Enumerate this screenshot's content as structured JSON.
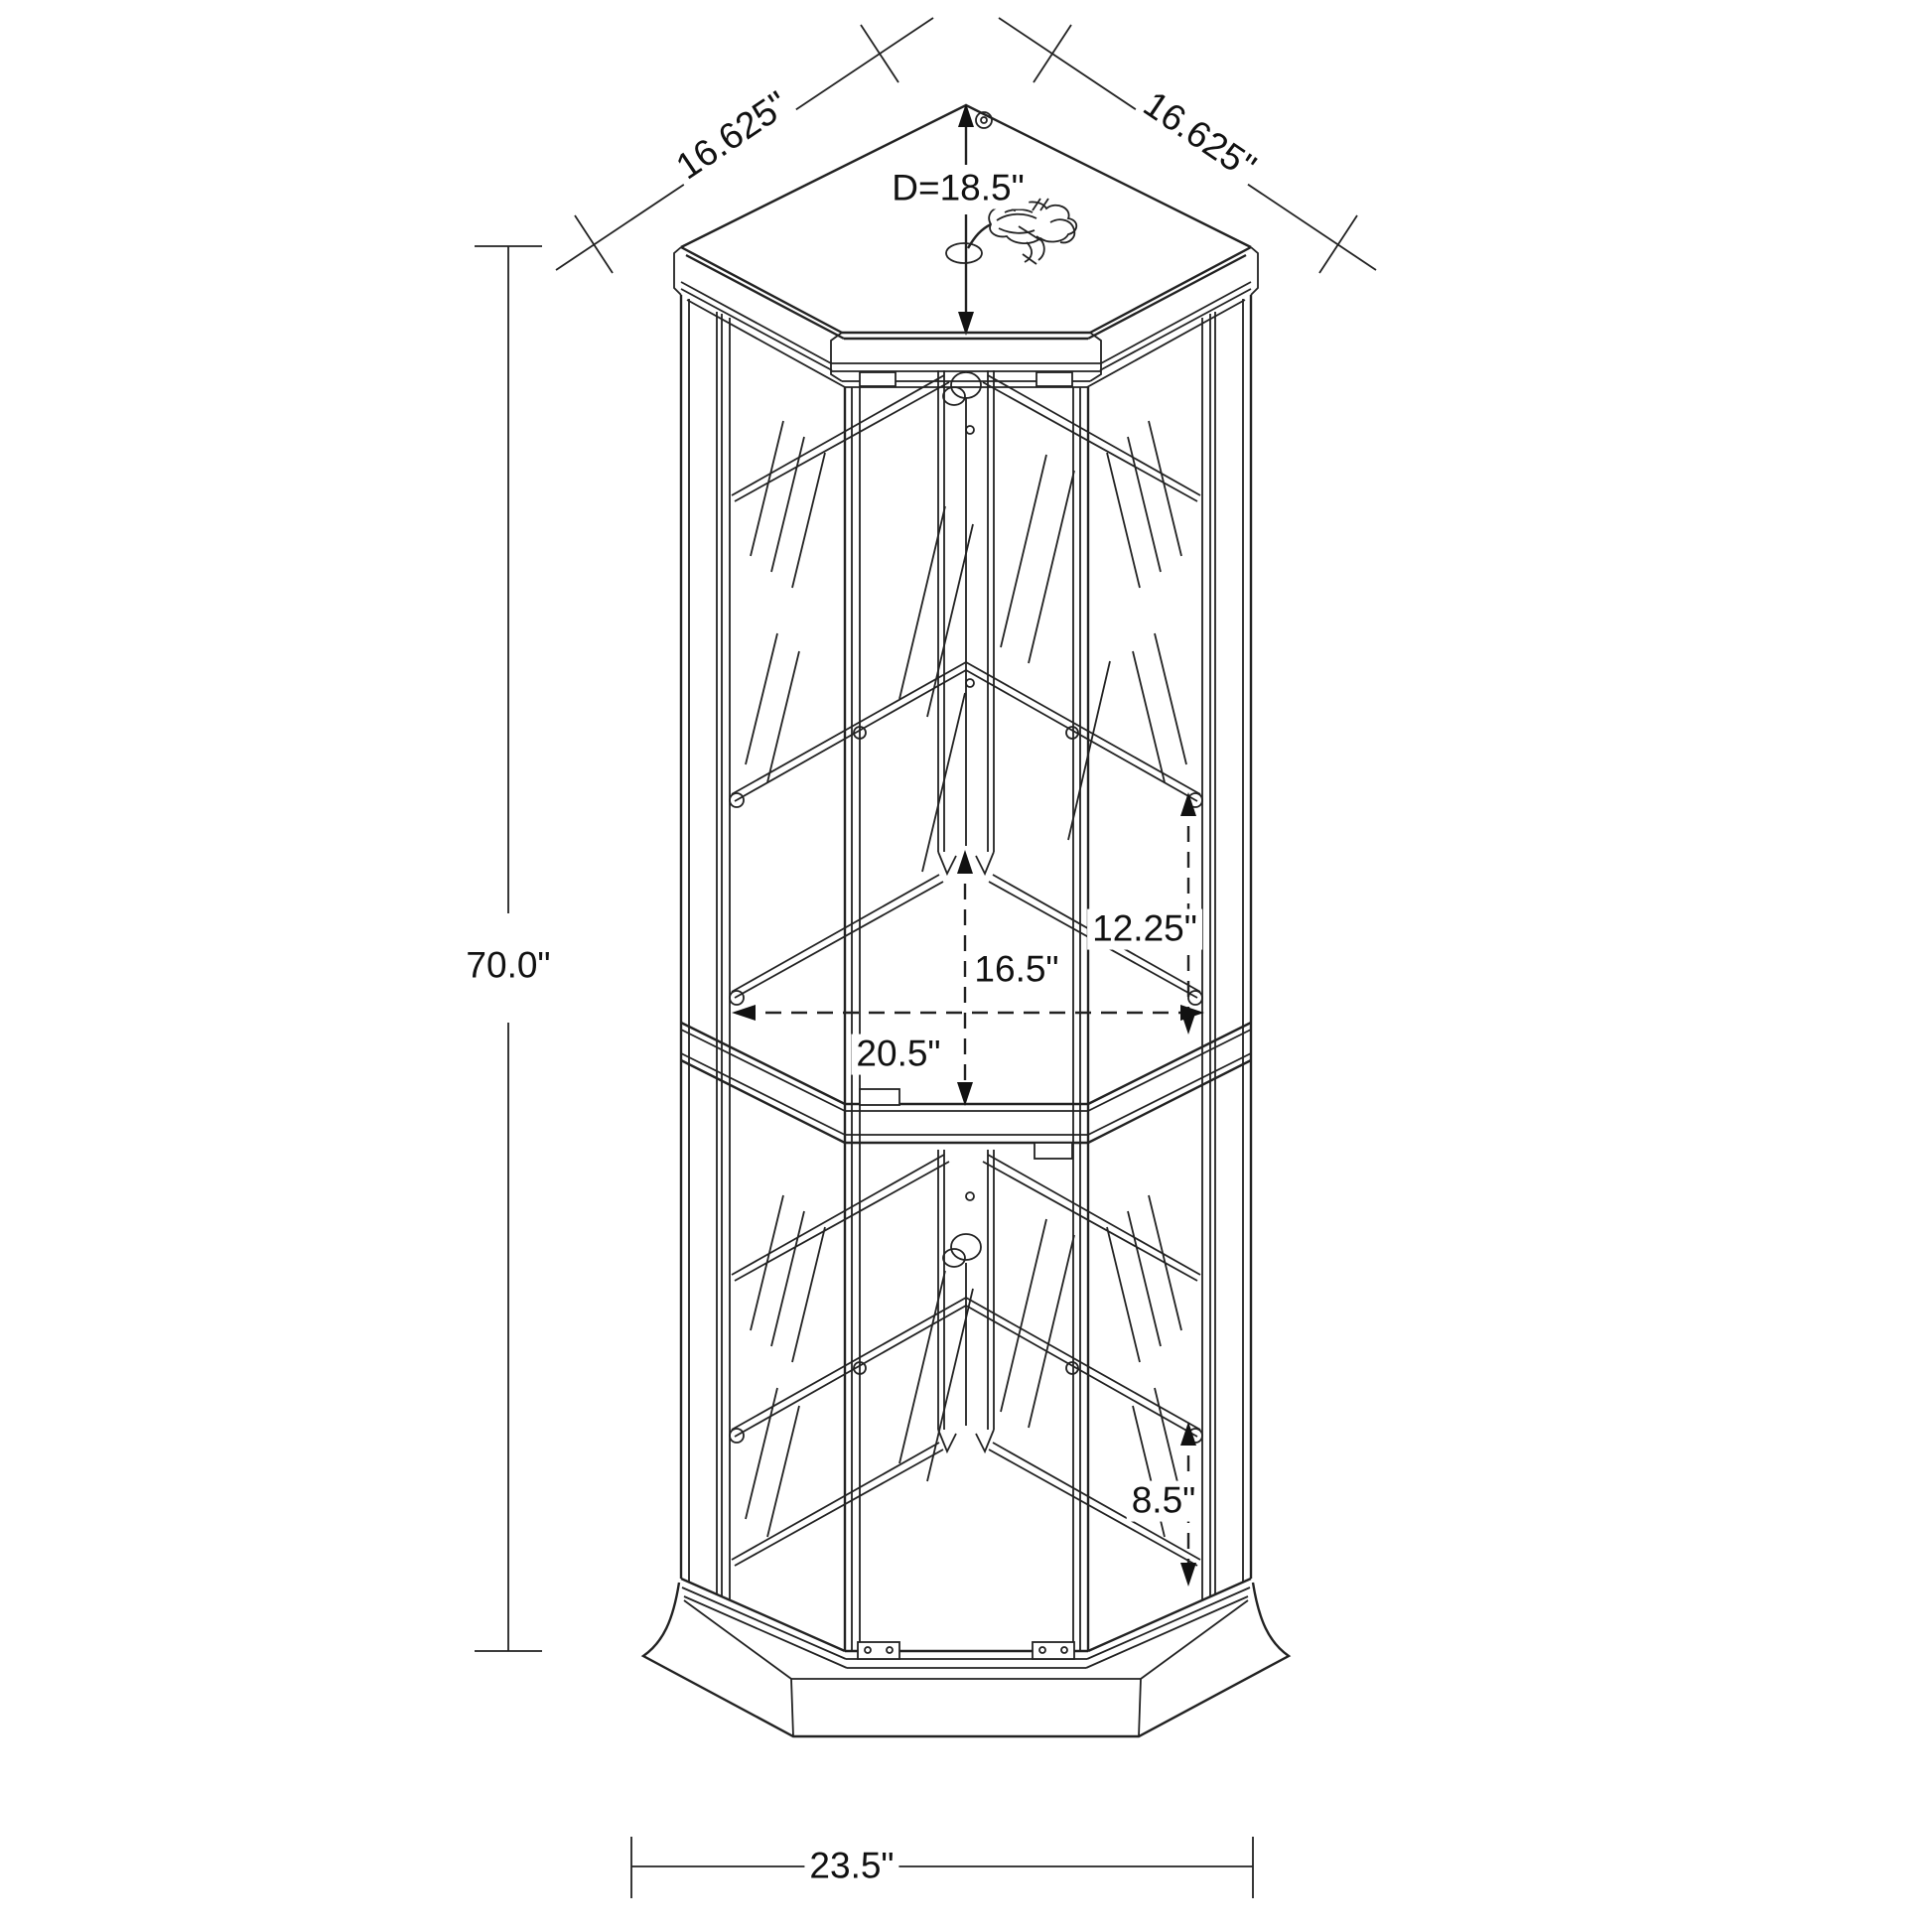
{
  "figure": {
    "dimensions": {
      "overall_height": "70.0\"",
      "base_width": "23.5\"",
      "top_edge_left": "16.625\"",
      "top_edge_right": "16.625\"",
      "top_depth_diagonal": "D=18.5\"",
      "upper_shelf_spacing": "12.25\"",
      "middle_shelf_spacing": "16.5\"",
      "interior_width": "20.5\"",
      "lower_shelf_spacing": "8.5\""
    }
  }
}
